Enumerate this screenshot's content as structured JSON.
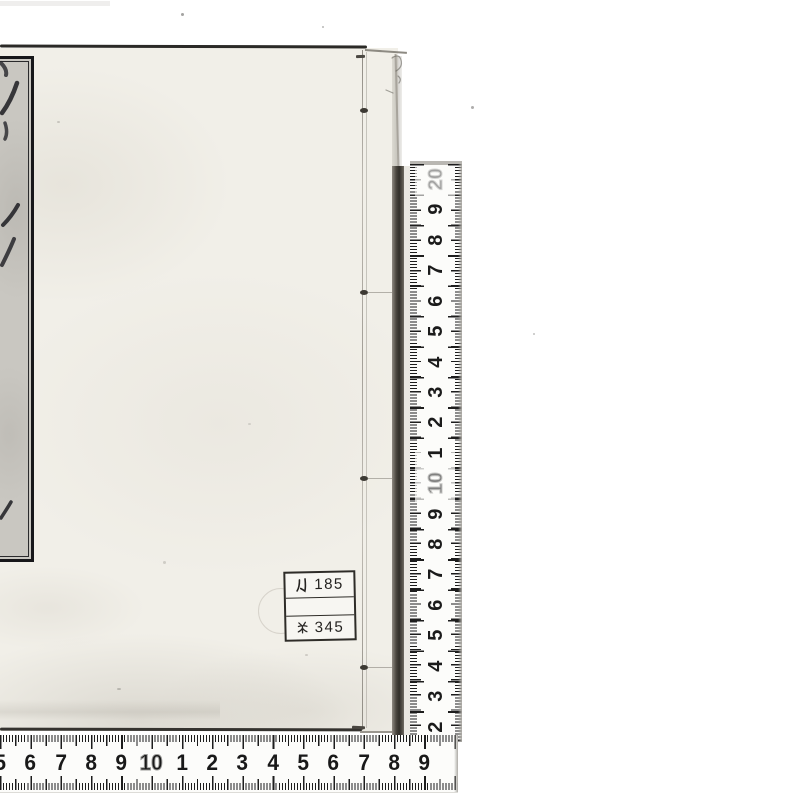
{
  "labels": {
    "call_number_label": {
      "row1": {
        "prefix": "ル",
        "number": "185"
      },
      "row2": "",
      "row3": {
        "prefix": "㐧",
        "number": "345"
      }
    }
  },
  "vertical_ruler": {
    "orientation": "vertical",
    "numbers_top_to_bottom": [
      {
        "t": "20",
        "cls": "outline vfaint"
      },
      {
        "t": "9"
      },
      {
        "t": "8"
      },
      {
        "t": "7"
      },
      {
        "t": "6"
      },
      {
        "t": "5"
      },
      {
        "t": "4"
      },
      {
        "t": "3"
      },
      {
        "t": "2"
      },
      {
        "t": "1"
      },
      {
        "t": "10",
        "cls": "outline faint"
      },
      {
        "t": "9"
      },
      {
        "t": "8"
      },
      {
        "t": "7"
      },
      {
        "t": "6"
      },
      {
        "t": "5"
      },
      {
        "t": "4"
      },
      {
        "t": "3"
      },
      {
        "t": "2"
      }
    ]
  },
  "horizontal_ruler": {
    "orientation": "horizontal",
    "numbers_left_to_right": [
      {
        "t": "5"
      },
      {
        "t": "6"
      },
      {
        "t": "7"
      },
      {
        "t": "8"
      },
      {
        "t": "9"
      },
      {
        "t": "10",
        "cls": "outline"
      },
      {
        "t": "1"
      },
      {
        "t": "2"
      },
      {
        "t": "3"
      },
      {
        "t": "4"
      },
      {
        "t": "5"
      },
      {
        "t": "6"
      },
      {
        "t": "7"
      },
      {
        "t": "8"
      },
      {
        "t": "9"
      }
    ]
  },
  "colors": {
    "paper": "#f1efe8",
    "slip_gray": "#c9c7c1",
    "ruler_white": "#fcfcfa",
    "ink": "#1b1b1b"
  }
}
